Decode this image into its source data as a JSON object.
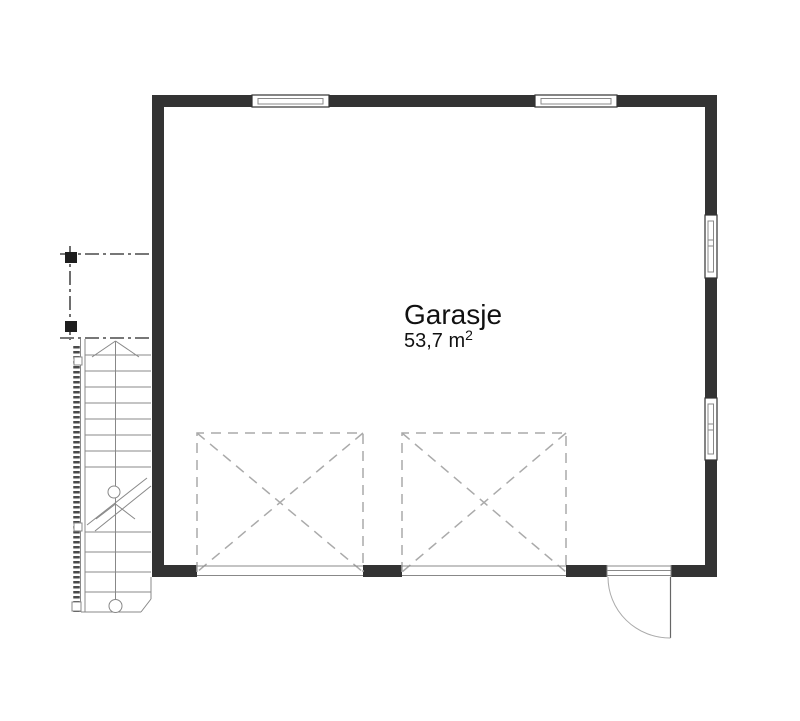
{
  "room": {
    "name": "Garasje",
    "area_main": "53,7 m",
    "area_sup": "2"
  },
  "colors": {
    "wall": "#333333",
    "outline": "#4a4a4a",
    "line-mid": "#888888",
    "line-light": "#aaaaaa",
    "text": "#111111"
  }
}
